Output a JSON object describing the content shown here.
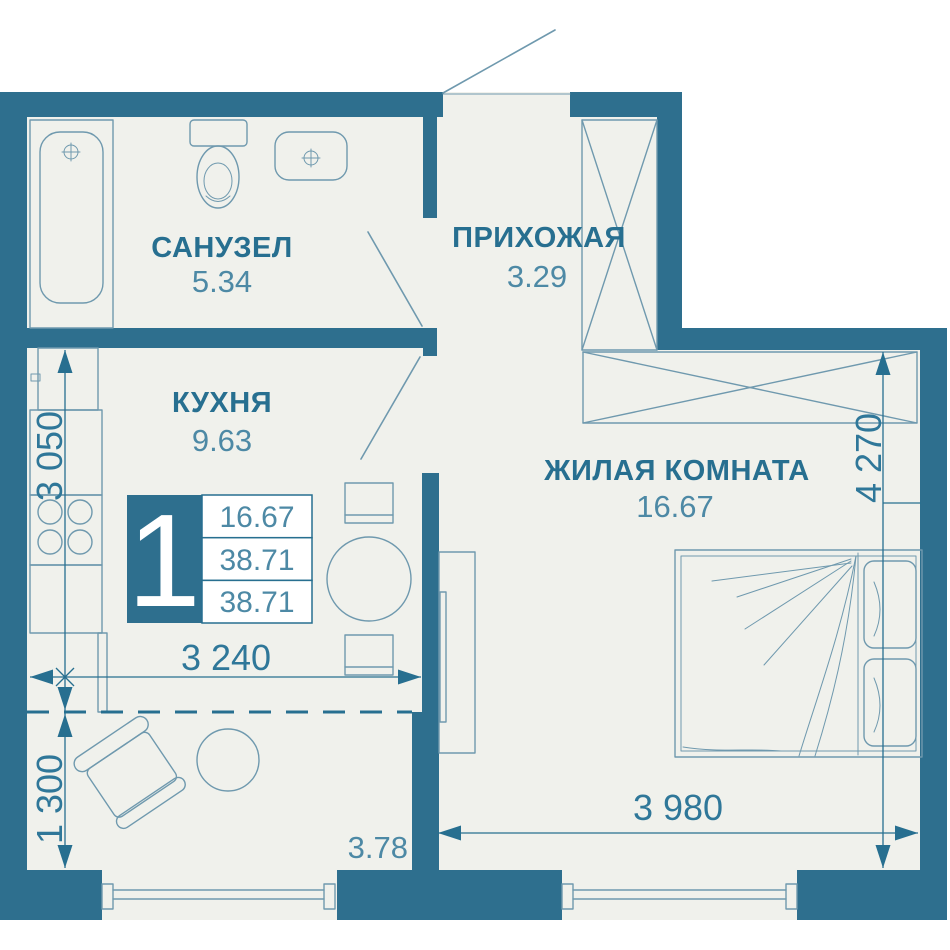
{
  "rooms": {
    "bathroom": {
      "label": "САНУЗЕЛ",
      "area": "5.34"
    },
    "hallway": {
      "label": "ПРИХОЖАЯ",
      "area": "3.29"
    },
    "kitchen": {
      "label": "КУХНЯ",
      "area": "9.63"
    },
    "living_room": {
      "label": "ЖИЛАЯ КОМНАТА",
      "area": "16.67"
    },
    "balcony": {
      "area": "3.78"
    }
  },
  "badge": {
    "count": "1",
    "values": [
      "16.67",
      "38.71",
      "38.71"
    ]
  },
  "dims": {
    "kitchen_height": "3 050",
    "kitchen_width": "3 240",
    "balcony_depth": "1 300",
    "room_height": "4 270",
    "room_width": "3 980"
  },
  "colors": {
    "wall": "#2e6f8e",
    "floor": "#f0f1ec",
    "accent": "#276f90",
    "dim": "#2f7799",
    "area": "#4d89a5",
    "line": "#6f99ae"
  }
}
